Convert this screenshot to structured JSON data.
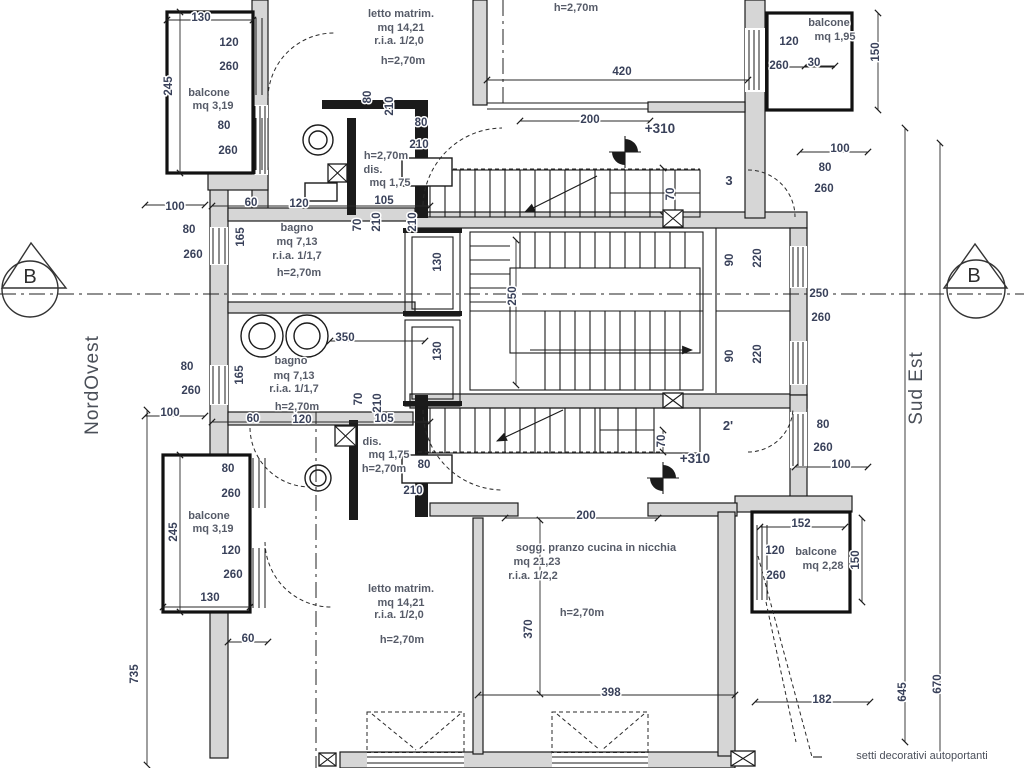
{
  "meta": {
    "drawing_type": "architectural floor plan",
    "background_color": "#ffffff",
    "line_color": "#1b1b1b",
    "wall_fill_color": "#d6d6d6",
    "dimension_text_color": "#39415a",
    "room_text_color": "#565b68"
  },
  "rooms": [
    {
      "id": "letto-matrim-nord",
      "labels": [
        {
          "t": "letto matrim.",
          "x": 401,
          "y": 17
        },
        {
          "t": "mq 14,21",
          "x": 401,
          "y": 31
        },
        {
          "t": "r.i.a. 1/2,0",
          "x": 399,
          "y": 44
        },
        {
          "t": "h=2,70m",
          "x": 403,
          "y": 64
        }
      ]
    },
    {
      "id": "stanza-centro-nord",
      "labels": [
        {
          "t": "h=2,70m",
          "x": 576,
          "y": 11
        }
      ]
    },
    {
      "id": "balcone-nord-est",
      "labels": [
        {
          "t": "balcone",
          "x": 829,
          "y": 26
        },
        {
          "t": "mq 1,95",
          "x": 835,
          "y": 40
        }
      ]
    },
    {
      "id": "balcone-nord-ovest",
      "labels": [
        {
          "t": "balcone",
          "x": 209,
          "y": 96
        },
        {
          "t": "mq 3,19",
          "x": 213,
          "y": 109
        }
      ]
    },
    {
      "id": "bagno-nord",
      "labels": [
        {
          "t": "bagno",
          "x": 297,
          "y": 231
        },
        {
          "t": "mq 7,13",
          "x": 297,
          "y": 245
        },
        {
          "t": "r.i.a. 1/1,7",
          "x": 297,
          "y": 259
        },
        {
          "t": "h=2,70m",
          "x": 299,
          "y": 276
        }
      ]
    },
    {
      "id": "dis-nord",
      "labels": [
        {
          "t": "h=2,70m",
          "x": 386,
          "y": 159
        },
        {
          "t": "dis.",
          "x": 373,
          "y": 173
        },
        {
          "t": "mq 1,75",
          "x": 390,
          "y": 186
        }
      ]
    },
    {
      "id": "bagno-sud",
      "labels": [
        {
          "t": "bagno",
          "x": 291,
          "y": 364
        },
        {
          "t": "mq 7,13",
          "x": 294,
          "y": 379
        },
        {
          "t": "r.i.a. 1/1,7",
          "x": 294,
          "y": 392
        },
        {
          "t": "h=2,70m",
          "x": 297,
          "y": 410
        }
      ]
    },
    {
      "id": "dis-sud",
      "labels": [
        {
          "t": "dis.",
          "x": 372,
          "y": 445
        },
        {
          "t": "mq 1,75",
          "x": 389,
          "y": 458
        },
        {
          "t": "h=2,70m",
          "x": 384,
          "y": 472
        }
      ]
    },
    {
      "id": "balcone-sud-ovest",
      "labels": [
        {
          "t": "balcone",
          "x": 209,
          "y": 519
        },
        {
          "t": "mq 3,19",
          "x": 213,
          "y": 532
        }
      ]
    },
    {
      "id": "letto-matrim-sud",
      "labels": [
        {
          "t": "letto matrim.",
          "x": 401,
          "y": 592
        },
        {
          "t": "mq 14,21",
          "x": 401,
          "y": 606
        },
        {
          "t": "r.i.a. 1/2,0",
          "x": 399,
          "y": 618
        },
        {
          "t": "h=2,70m",
          "x": 402,
          "y": 643
        }
      ]
    },
    {
      "id": "soggiorno",
      "labels": [
        {
          "t": "sogg. pranzo cucina in nicchia",
          "x": 596,
          "y": 551
        },
        {
          "t": "mq 21,23",
          "x": 537,
          "y": 565
        },
        {
          "t": "r.i.a. 1/2,2",
          "x": 533,
          "y": 579
        },
        {
          "t": "h=2,70m",
          "x": 582,
          "y": 616
        }
      ]
    },
    {
      "id": "balcone-sud-est",
      "labels": [
        {
          "t": "balcone",
          "x": 816,
          "y": 555
        },
        {
          "t": "mq 2,28",
          "x": 823,
          "y": 569
        }
      ]
    }
  ],
  "dimensions": [
    {
      "t": "130",
      "x": 201,
      "y": 21
    },
    {
      "t": "120",
      "x": 229,
      "y": 46
    },
    {
      "t": "260",
      "x": 229,
      "y": 70
    },
    {
      "t": "245",
      "x": 172,
      "y": 86,
      "r": 1
    },
    {
      "t": "80",
      "x": 224,
      "y": 129
    },
    {
      "t": "260",
      "x": 228,
      "y": 154
    },
    {
      "t": "100",
      "x": 175,
      "y": 210
    },
    {
      "t": "60",
      "x": 251,
      "y": 206
    },
    {
      "t": "120",
      "x": 299,
      "y": 207
    },
    {
      "t": "105",
      "x": 384,
      "y": 204
    },
    {
      "t": "80",
      "x": 189,
      "y": 233
    },
    {
      "t": "260",
      "x": 193,
      "y": 258
    },
    {
      "t": "165",
      "x": 244,
      "y": 237,
      "r": 1
    },
    {
      "t": "70",
      "x": 361,
      "y": 225,
      "r": 1
    },
    {
      "t": "210",
      "x": 380,
      "y": 222,
      "r": 1
    },
    {
      "t": "210",
      "x": 416,
      "y": 222,
      "r": 1
    },
    {
      "t": "80",
      "x": 371,
      "y": 97,
      "r": 1
    },
    {
      "t": "210",
      "x": 393,
      "y": 106,
      "r": 1
    },
    {
      "t": "80",
      "x": 421,
      "y": 126
    },
    {
      "t": "210",
      "x": 419,
      "y": 148
    },
    {
      "t": "420",
      "x": 622,
      "y": 75
    },
    {
      "t": "200",
      "x": 590,
      "y": 123
    },
    {
      "t": "70",
      "x": 674,
      "y": 194,
      "r": 1
    },
    {
      "t": "130",
      "x": 441,
      "y": 262,
      "r": 1
    },
    {
      "t": "130",
      "x": 441,
      "y": 351,
      "r": 1
    },
    {
      "t": "250",
      "x": 516,
      "y": 296,
      "r": 1
    },
    {
      "t": "90",
      "x": 733,
      "y": 260,
      "r": 1
    },
    {
      "t": "220",
      "x": 761,
      "y": 258,
      "r": 1
    },
    {
      "t": "90",
      "x": 733,
      "y": 356,
      "r": 1
    },
    {
      "t": "220",
      "x": 761,
      "y": 354,
      "r": 1
    },
    {
      "t": "250",
      "x": 819,
      "y": 297
    },
    {
      "t": "260",
      "x": 821,
      "y": 321
    },
    {
      "t": "120",
      "x": 789,
      "y": 45
    },
    {
      "t": "260",
      "x": 779,
      "y": 69
    },
    {
      "t": "30",
      "x": 814,
      "y": 66
    },
    {
      "t": "150",
      "x": 879,
      "y": 52,
      "r": 1
    },
    {
      "t": "100",
      "x": 840,
      "y": 152
    },
    {
      "t": "80",
      "x": 825,
      "y": 171
    },
    {
      "t": "260",
      "x": 824,
      "y": 192
    },
    {
      "t": "80",
      "x": 823,
      "y": 428
    },
    {
      "t": "260",
      "x": 823,
      "y": 451
    },
    {
      "t": "100",
      "x": 841,
      "y": 468
    },
    {
      "t": "152",
      "x": 801,
      "y": 527
    },
    {
      "t": "120",
      "x": 775,
      "y": 554
    },
    {
      "t": "260",
      "x": 776,
      "y": 579
    },
    {
      "t": "150",
      "x": 859,
      "y": 560,
      "r": 1
    },
    {
      "t": "182",
      "x": 822,
      "y": 703
    },
    {
      "t": "645",
      "x": 906,
      "y": 692,
      "r": 1
    },
    {
      "t": "670",
      "x": 941,
      "y": 684,
      "r": 1
    },
    {
      "t": "398",
      "x": 611,
      "y": 696
    },
    {
      "t": "370",
      "x": 532,
      "y": 629,
      "r": 1
    },
    {
      "t": "200",
      "x": 586,
      "y": 519
    },
    {
      "t": "60",
      "x": 248,
      "y": 642
    },
    {
      "t": "735",
      "x": 138,
      "y": 674,
      "r": 1
    },
    {
      "t": "130",
      "x": 210,
      "y": 601
    },
    {
      "t": "245",
      "x": 177,
      "y": 532,
      "r": 1
    },
    {
      "t": "80",
      "x": 228,
      "y": 472
    },
    {
      "t": "260",
      "x": 231,
      "y": 497
    },
    {
      "t": "120",
      "x": 231,
      "y": 554
    },
    {
      "t": "260",
      "x": 233,
      "y": 578
    },
    {
      "t": "100",
      "x": 170,
      "y": 416
    },
    {
      "t": "60",
      "x": 253,
      "y": 422
    },
    {
      "t": "120",
      "x": 302,
      "y": 423
    },
    {
      "t": "105",
      "x": 384,
      "y": 422
    },
    {
      "t": "70",
      "x": 362,
      "y": 399,
      "r": 1
    },
    {
      "t": "210",
      "x": 381,
      "y": 403,
      "r": 1
    },
    {
      "t": "80",
      "x": 424,
      "y": 468
    },
    {
      "t": "210",
      "x": 413,
      "y": 494
    },
    {
      "t": "70",
      "x": 665,
      "y": 441,
      "r": 1
    },
    {
      "t": "350",
      "x": 345,
      "y": 341
    },
    {
      "t": "80",
      "x": 187,
      "y": 370
    },
    {
      "t": "260",
      "x": 191,
      "y": 394
    },
    {
      "t": "165",
      "x": 243,
      "y": 375,
      "r": 1
    }
  ],
  "annotations": {
    "compass_left": {
      "t": "NordOvest",
      "x": 98,
      "y": 385
    },
    "compass_right": {
      "t": "Sud Est",
      "x": 922,
      "y": 388
    },
    "section_b_left": {
      "t": "B",
      "x": 30,
      "y": 283
    },
    "section_b_right": {
      "t": "B",
      "x": 974,
      "y": 282
    },
    "level_marks": [
      {
        "t": "+310",
        "x": 660,
        "y": 133
      },
      {
        "t": "+310",
        "x": 695,
        "y": 463
      }
    ],
    "door_tags": [
      {
        "t": "3",
        "x": 729,
        "y": 185
      },
      {
        "t": "2'",
        "x": 728,
        "y": 430
      }
    ],
    "note": {
      "t": "setti decorativi autoportanti",
      "x": 922,
      "y": 759
    }
  }
}
